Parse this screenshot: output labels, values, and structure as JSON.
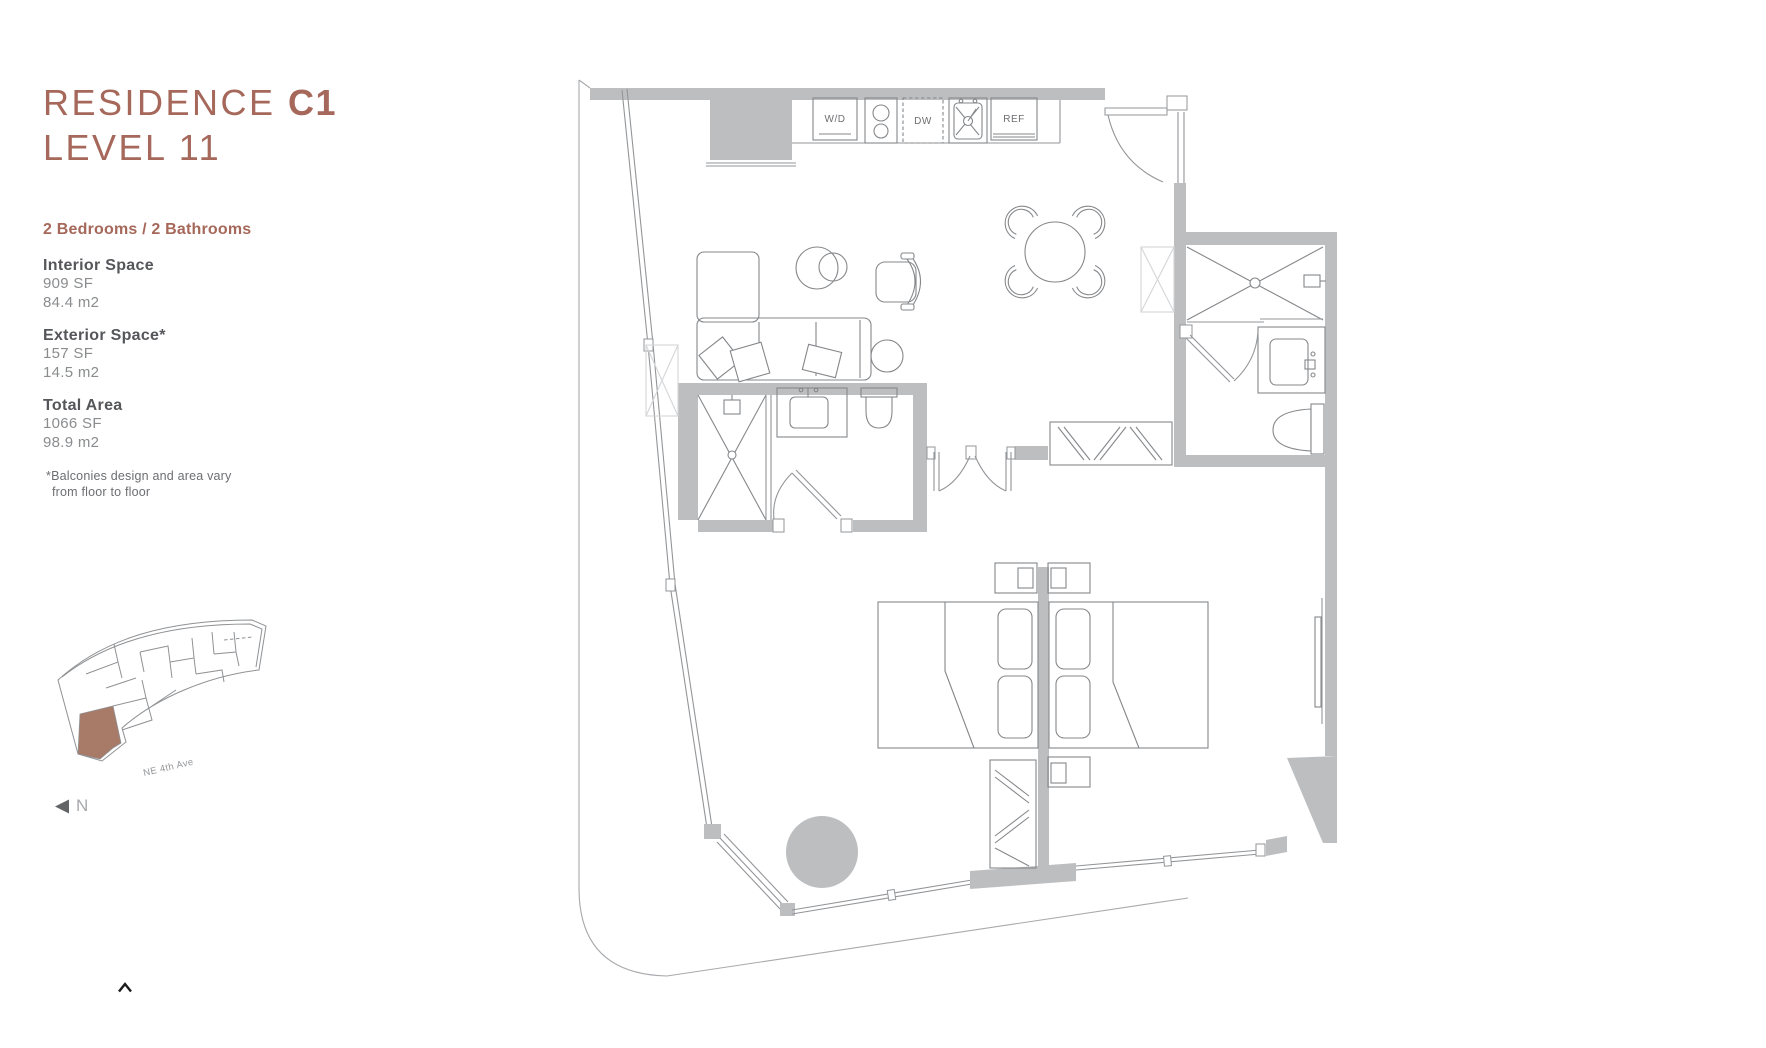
{
  "colors": {
    "accent_brown": "#a5685a",
    "highlight_unit": "#a87a68",
    "wall_gray": "#bcbec0",
    "line_gray": "#939598",
    "pale_gray": "#d4d5d7",
    "text_dark": "#55565a",
    "text_mid": "#8a8c8e",
    "text_light": "#6d6e71"
  },
  "sidebar": {
    "title_line1_regular": "RESIDENCE ",
    "title_line1_bold": "C1",
    "title_line2": "LEVEL 11",
    "subtitle": "2 Bedrooms / 2 Bathrooms",
    "stats": [
      {
        "label": "Interior Space",
        "sf": "909 SF",
        "m2": "84.4 m2"
      },
      {
        "label": "Exterior Space*",
        "sf": "157 SF",
        "m2": "14.5 m2"
      },
      {
        "label": "Total Area",
        "sf": "1066 SF",
        "m2": "98.9 m2"
      }
    ],
    "footnote_line1": "*Balconies design and area vary",
    "footnote_line2": "from floor to floor",
    "keyplan": {
      "street_label": "NE 4th Ave",
      "north_label": "N"
    }
  },
  "floorplan": {
    "labels": {
      "washer_dryer": "W/D",
      "dishwasher": "DW",
      "refrigerator": "REF"
    }
  }
}
